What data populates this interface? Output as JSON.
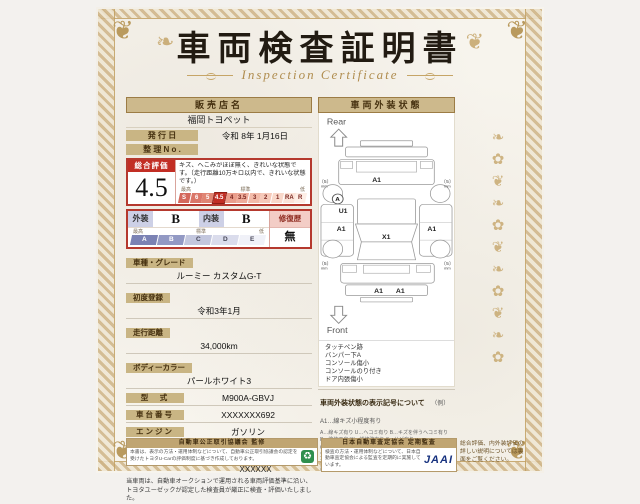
{
  "page": {
    "title": "車両検査証明書",
    "subtitle": "Inspection Certificate"
  },
  "seller": {
    "header": "販売店名",
    "name": "福岡トヨペット",
    "issue_label": "発 行 日",
    "issue_value": "令和 8年 1月16日",
    "ref_label": "整 理 N o .",
    "ref_value": ""
  },
  "overall": {
    "label": "総合評価",
    "score": "4.5",
    "description": "キズ、へこみがほぼ無く、きれいな状態です。（走行距離10万キロ以内で、きれいな状態です。）",
    "scale_left": "最高",
    "scale_mid": "標準",
    "scale_right": "低",
    "scale": [
      "S",
      "6",
      "5",
      "4.5",
      "4",
      "3.5",
      "3",
      "2",
      "1",
      "RA",
      "R"
    ]
  },
  "grades": {
    "exterior_label": "外装",
    "exterior_value": "B",
    "interior_label": "内装",
    "interior_value": "B",
    "repair_label": "修復歴",
    "repair_value": "無",
    "scale_left": "最高",
    "scale_mid": "標準",
    "scale_right": "低",
    "scale": [
      "A",
      "B",
      "C",
      "D",
      "E"
    ]
  },
  "details": [
    {
      "label": "車種・グレード",
      "value": "ルーミー カスタムG-T"
    },
    {
      "label": "初度登録",
      "value": "令和3年1月"
    },
    {
      "label": "走行距離",
      "value": "34,000km"
    },
    {
      "label": "ボディーカラー",
      "value": "パールホワイト3"
    },
    {
      "label": "型　式",
      "value": "M900A-GBVJ"
    },
    {
      "label": "車台番号",
      "value": "XXXXXXX692"
    },
    {
      "label": "エンジン",
      "value": "ガソリン"
    }
  ],
  "inspector": {
    "logo": "TOYOTA",
    "badge": "トヨタ認定車両検査員",
    "id": "XXXXXX"
  },
  "disclaimer": "当車両は、自動車オークションで運用される車両評価基準に沿い、トヨタユーゼックが認定した検査員が厳正に検査・評価いたしました。",
  "exterior": {
    "header": "車両外装状態",
    "rear": "Rear",
    "front": "Front",
    "marks": {
      "rear_gate": "A1",
      "left_quarter": "U1",
      "left_door": "A1",
      "right_door": "A1",
      "hood": "X1",
      "front_bumper_l": "A1",
      "front_bumper_r": "A1",
      "wheel_badge": "A",
      "tread": "5",
      "tread_unit": "mm"
    },
    "notes": [
      "タッチペン跡",
      "バンパー下A",
      "コンソール傷小",
      "コンソールのり付き",
      "ドア内張傷小"
    ],
    "legend_title": "車両外装状態の表示記号について",
    "legend_example": "（例）A1…線キズ小程度有り",
    "legend_lines": [
      "A…線キズ有り U…ヘコミ有り B…キズを伴うヘコミ有り P…塗装不良 W…補修跡有り S…サビ有り",
      "C…腐食有り G…フロントガラス状態有り X…要交換 XX…交換済有り",
      "1…小程度 2…中程度 3…中程度以上 ※マークは該当位置に記載しております。"
    ]
  },
  "footer": {
    "fair_trade": {
      "title": "自動車公正取引協議会 監修",
      "text": "本書は、表示の方法・運用体制などについて、自動車公正取引協議会の認定を受けたトヨタU-Carの評価制度に基づき作成しております。"
    },
    "jaai": {
      "title": "日本自動車査定協会 定期監査",
      "text": "検査の方法・運用体制などについて、日本自動車査定協会による監査を定期的に実施しています。",
      "logo": "JAAI"
    },
    "back_note": "総合評価、内外装評価の詳しい説明については裏面をご覧ください。"
  }
}
